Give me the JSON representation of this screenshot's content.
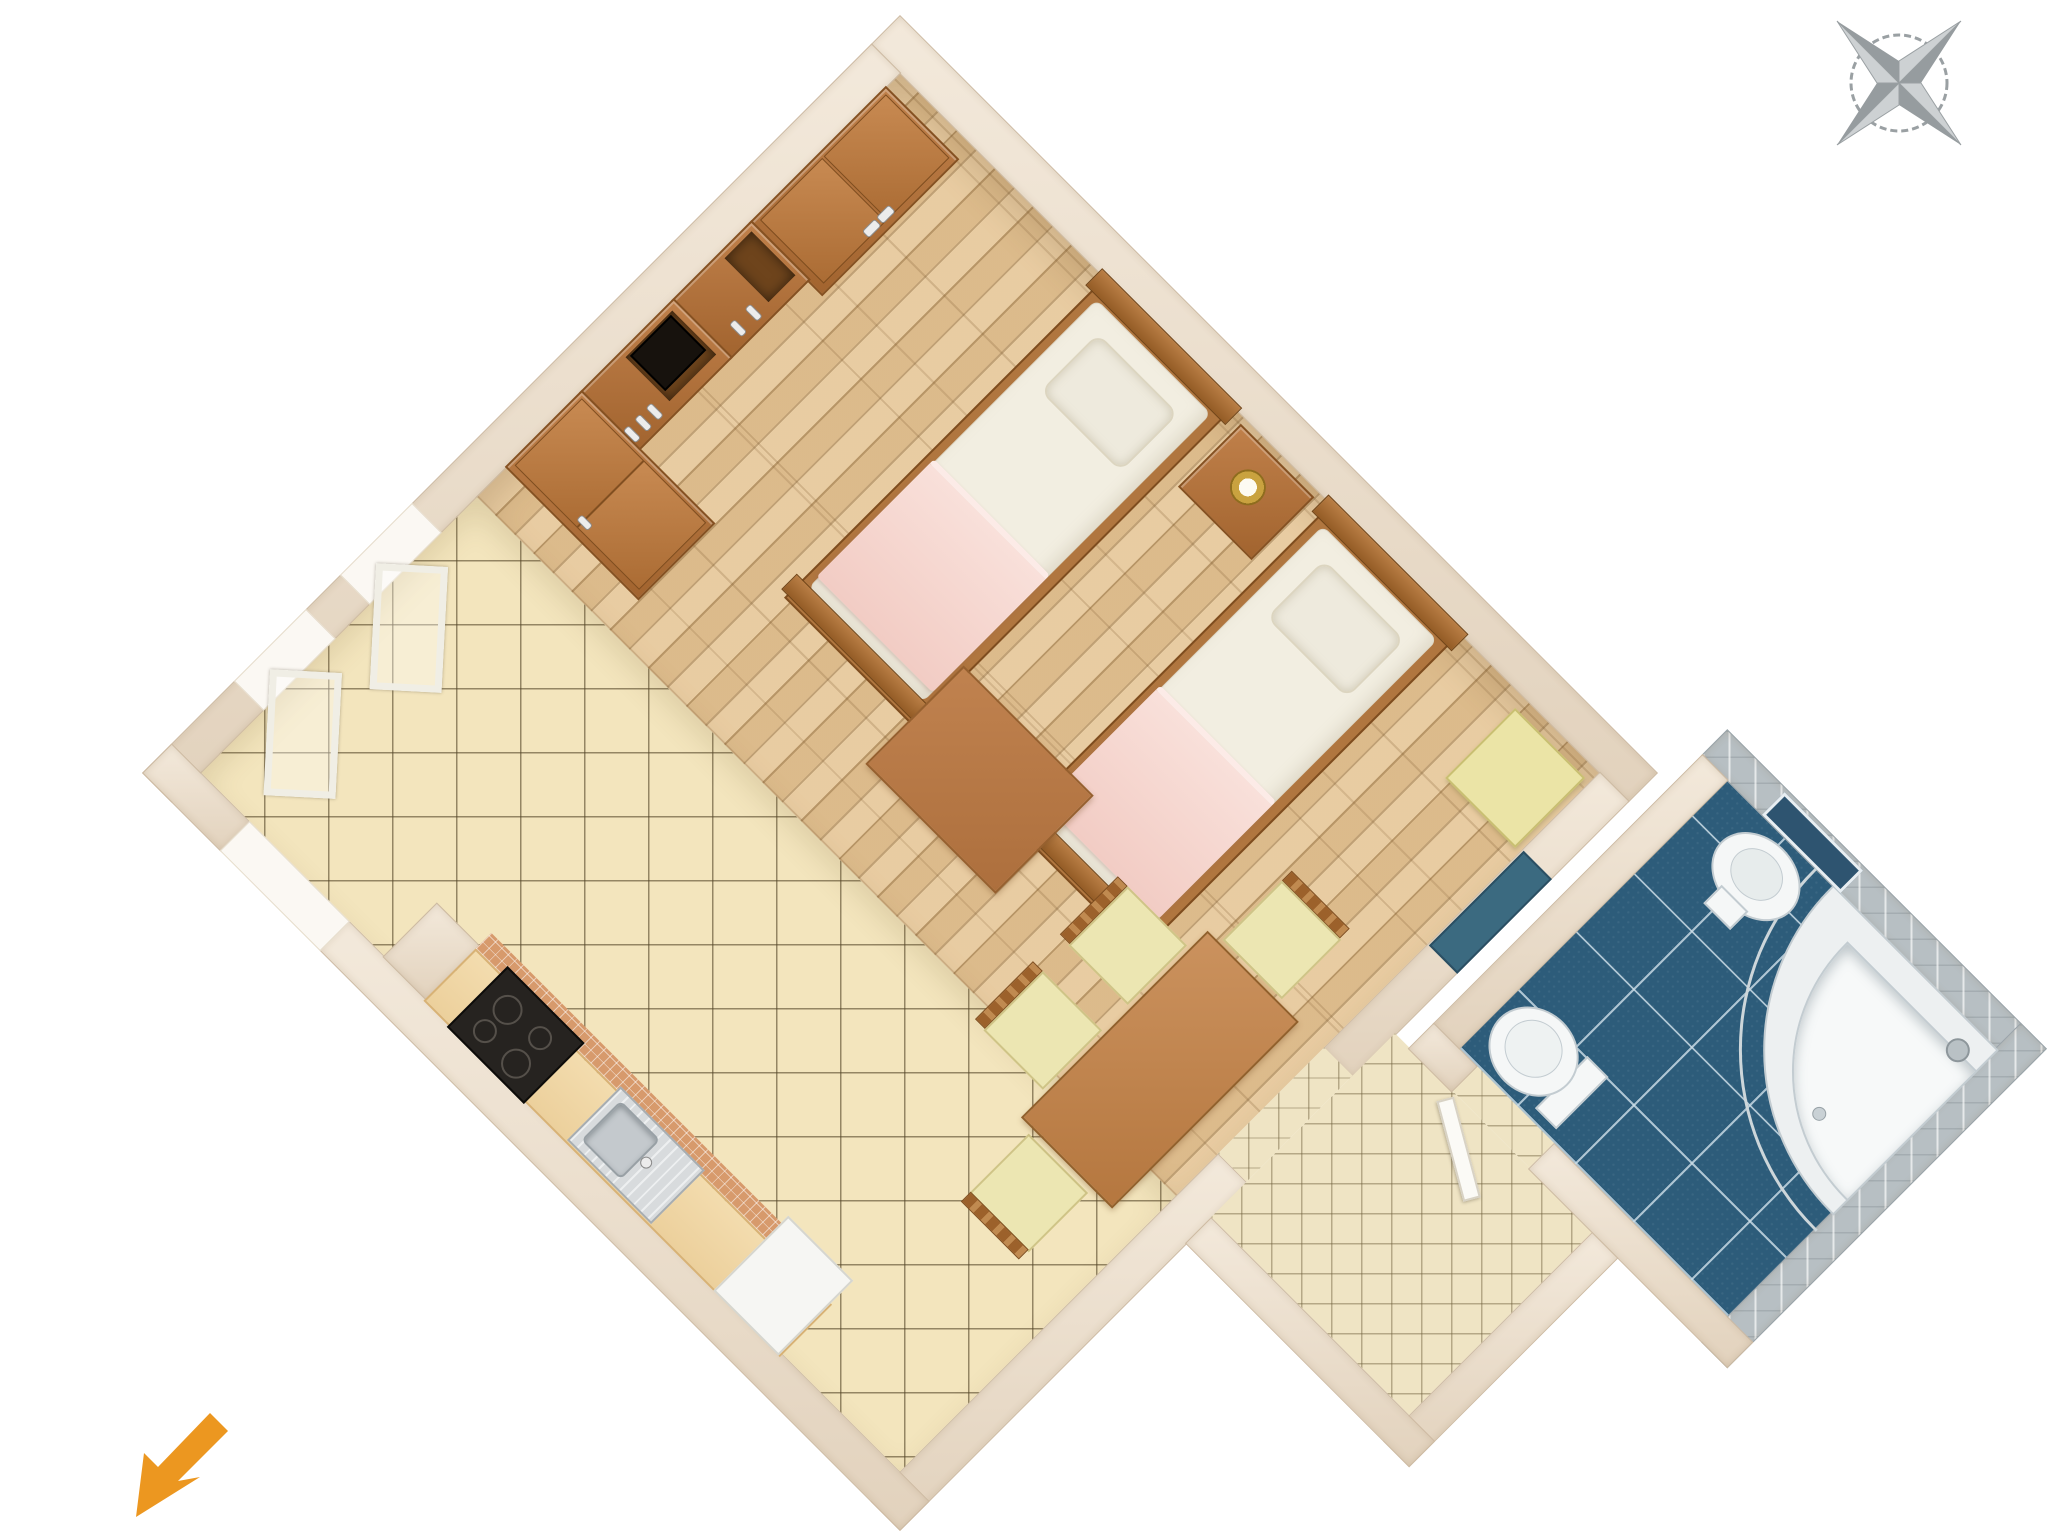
{
  "meta": {
    "title": "Studio apartment 3D floor plan",
    "background_color": "#ffffff",
    "view": "top-down axonometric, plan rotated 45 degrees"
  },
  "palette": {
    "wall": "#e9dcca",
    "wood_floor": "#e6c697",
    "kitchen_tile": "#f3e5bd",
    "hall_tile": "#efe4c4",
    "bathroom_floor_tile": "#2d5c7a",
    "bathroom_wall_tile": "#b7bfc3",
    "furniture_wood": "#a96a36",
    "counter_wood": "#ecd09c",
    "mosaic_backsplash": "#d79a6c",
    "bed_linen": "#f2eee1",
    "bed_blanket": "#f6d5ce",
    "chair_cushion": "#ece6b2",
    "stool": "#ebe4a6",
    "fixture_white": "#f5f7f7",
    "compass_gray": "#9aa0a3",
    "arrow_orange": "#ec9720"
  },
  "icons": {
    "compass": {
      "label": "compass rose",
      "color": "#9aa0a3"
    },
    "entrance_arrow": {
      "label": "entrance direction arrow",
      "direction": "southwest",
      "color": "#ec9720"
    }
  },
  "rooms": {
    "main": {
      "label": "Main room: sleeping area, dining area and kitchen corner",
      "floor_zones": [
        "wood plank floor",
        "ceramic tile kitchen floor"
      ],
      "furniture": [
        "two-door wardrobe",
        "shelf chest",
        "TV cabinet with drawers",
        "television",
        "tall wardrobe",
        "single bed 1",
        "single bed 2",
        "bedside table with lamp",
        "side stool",
        "wooden rug",
        "dining table",
        "chair 1",
        "chair 2",
        "chair 3",
        "chair 4",
        "open window 1",
        "open window 2",
        "kitchen counter",
        "stove",
        "kitchen sink",
        "kitchen cabinet",
        "mosaic backsplash",
        "entrance threshold",
        "glazed wall window"
      ]
    },
    "hallway": {
      "label": "Entry hall",
      "floor": "small ceramic tiles",
      "features": [
        "open bathroom door"
      ]
    },
    "bathroom": {
      "label": "Bathroom",
      "floor": "blue ceramic tiles",
      "walls": "grey ceramic tiles",
      "fixtures": [
        "washbasin",
        "mirror",
        "corner shower cabin",
        "shower door",
        "shower head",
        "toilet bowl",
        "toilet cistern"
      ]
    }
  }
}
